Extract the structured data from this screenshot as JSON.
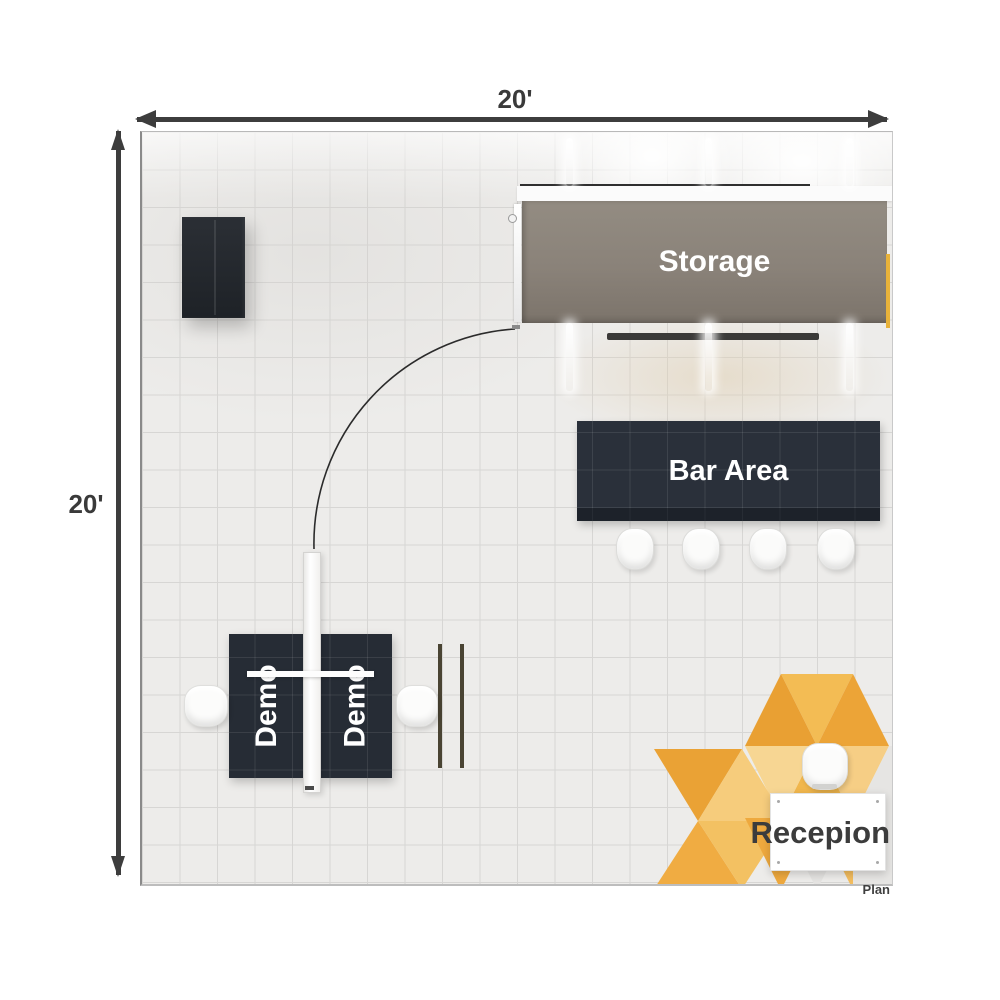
{
  "dimensions": {
    "width_label": "20'",
    "height_label": "20'"
  },
  "areas": {
    "storage": {
      "label": "Storage",
      "color": "#8a8279"
    },
    "bar": {
      "label": "Bar Area",
      "color": "#2a303a",
      "stool_count": 4
    },
    "demo": {
      "color": "#262c35",
      "stations": [
        {
          "label": "Demo"
        },
        {
          "label": "Demo"
        }
      ]
    },
    "reception": {
      "label": "Recepion",
      "accent_color": "#efac3d",
      "desk_color": "#ffffff"
    }
  },
  "annotations": {
    "plan_label": "Plan"
  },
  "floor": {
    "grid_feet": 20,
    "color": "#edecea",
    "grid_line_color": "#d7d6d4"
  },
  "palette": {
    "arrow_color": "#3d3d3d",
    "pattern_oranges": [
      "#e9a033",
      "#eda438",
      "#f3bc54",
      "#f6ce85",
      "#f1b74d",
      "#f7d693",
      "#eaa235",
      "#f0ac42",
      "#f6cc7c",
      "#f3c162"
    ]
  }
}
